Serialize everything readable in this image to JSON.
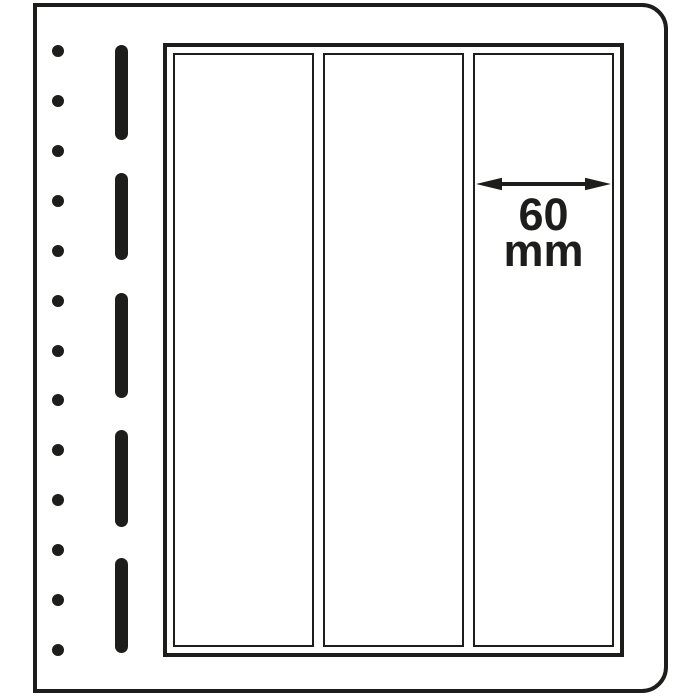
{
  "dimension": {
    "value": "60",
    "unit": "mm"
  },
  "colors": {
    "ink": "#1d1d1b",
    "paper": "#ffffff"
  },
  "page": {
    "binder_holes": {
      "count": 13,
      "x_center": 58,
      "first_center_y": 51,
      "last_center_y": 650,
      "diameter": 12
    },
    "perforation_dashes": {
      "x_left": 115,
      "width": 13,
      "segments_y": [
        [
          45,
          140
        ],
        [
          173,
          260
        ],
        [
          293,
          398
        ],
        [
          430,
          527
        ],
        [
          558,
          653
        ]
      ]
    },
    "pocket_strips": {
      "count": 3
    }
  }
}
